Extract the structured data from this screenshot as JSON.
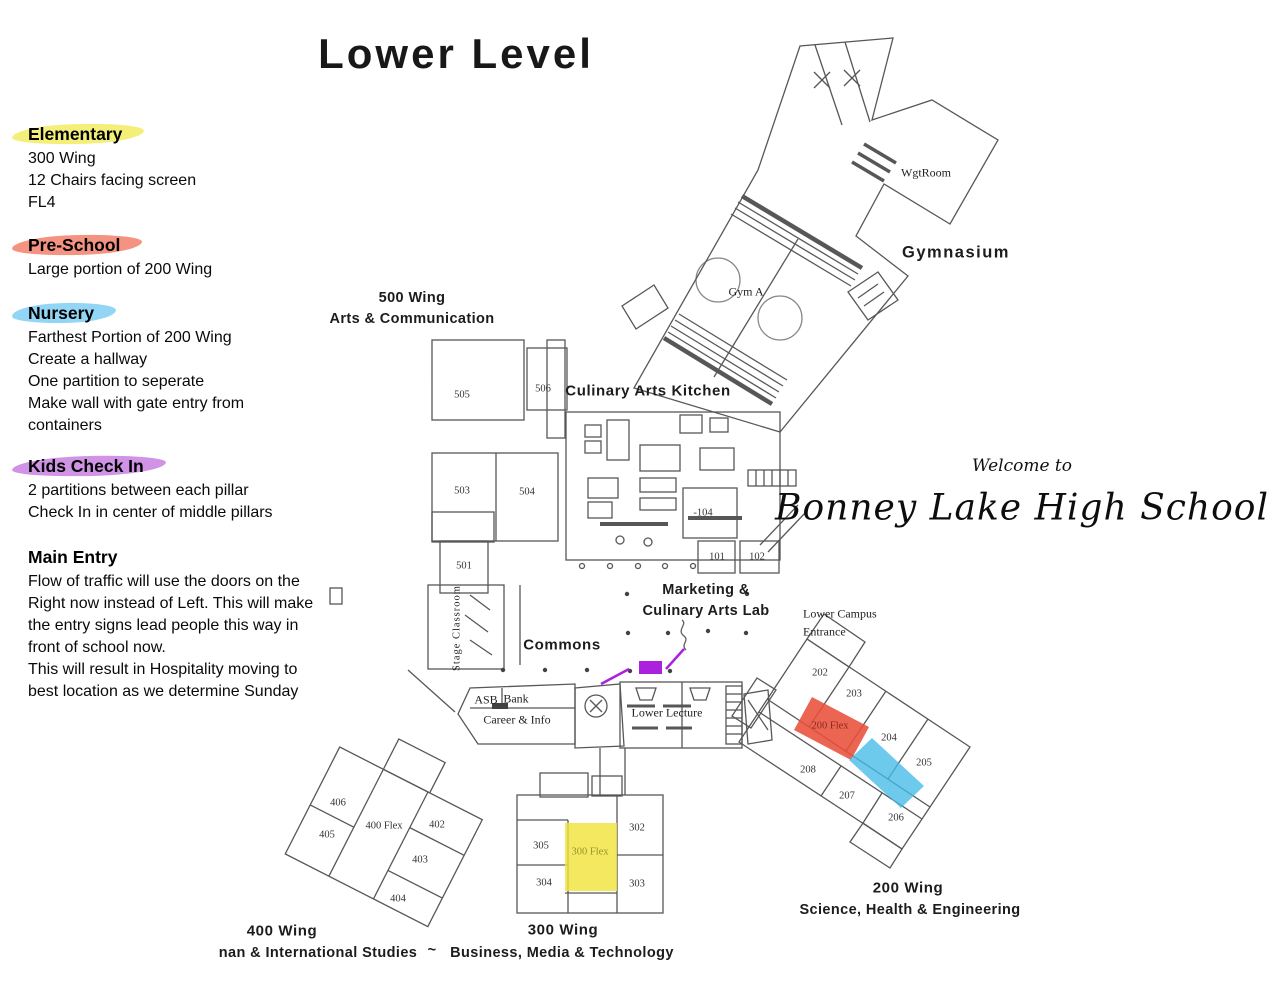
{
  "title": "Lower Level",
  "annotations": [
    {
      "heading": "Elementary",
      "highlight": "#f2ec62",
      "lines": [
        "300 Wing",
        "12 Chairs facing screen",
        "FL4"
      ]
    },
    {
      "heading": "Pre-School",
      "highlight": "#f3806c",
      "lines": [
        "Large portion of 200 Wing"
      ]
    },
    {
      "heading": "Nursery",
      "highlight": "#7fcef2",
      "lines": [
        "Farthest Portion of 200 Wing",
        "Create a hallway",
        "One partition to seperate",
        "Make wall with gate entry from",
        "containers"
      ]
    },
    {
      "heading": "Kids Check In",
      "highlight": "#c980e0",
      "lines": [
        "2 partitions between each pillar",
        "Check In in center of middle pillars"
      ]
    },
    {
      "heading": "Main Entry",
      "highlight": "",
      "lines": [
        "Flow of traffic will use the doors on the",
        "Right now instead of Left.  This will make",
        "the entry signs lead people this way in",
        "front of school now.",
        "This will result in Hospitality moving to",
        "best location as we determine Sunday"
      ]
    }
  ],
  "welcome": {
    "small": "Welcome to",
    "big": "Bonney Lake High School"
  },
  "map": {
    "labels": {
      "w500a": "500 Wing",
      "w500b": "Arts & Communication",
      "kitchen": "Culinary Arts Kitchen",
      "gymnasium": "Gymnasium",
      "wgtroom": "WgtRoom",
      "gym_a": "Gym A",
      "marketing_a": "Marketing &",
      "marketing_b": "Culinary Arts Lab",
      "lower_campus_a": "Lower Campus",
      "lower_campus_b": "Entrance",
      "commons": "Commons",
      "stage": "Stage Classroom",
      "asb": "ASB",
      "bank": "Bank",
      "career": "Career & Info",
      "lower_lecture": "Lower Lecture",
      "w200a": "200 Wing",
      "w200b": "Science, Health & Engineering",
      "w300a": "300 Wing",
      "w300b": "Business, Media & Technology",
      "w400a": "400 Wing",
      "w400b": "nan & International Studies",
      "dash": "~"
    },
    "rooms": {
      "r505": "505",
      "r506": "506",
      "r503": "503",
      "r504": "504",
      "r501": "501",
      "r104": "-104",
      "r101": "101",
      "r102": "102",
      "r202": "202",
      "r203": "203",
      "r204": "204",
      "r205": "205",
      "r206": "206",
      "r207": "207",
      "r208": "208",
      "flex200": "200 Flex",
      "r302": "302",
      "r303": "303",
      "r304": "304",
      "r305": "305",
      "flex300": "300 Flex",
      "r402": "402",
      "r403": "403",
      "r404": "404",
      "r405": "405",
      "r406": "406",
      "flex400": "400 Flex"
    },
    "highlights": {
      "red": "#e8503a",
      "blue": "#45bbe8",
      "yellow": "#f0e33c",
      "purple": "#aa22dd"
    }
  }
}
